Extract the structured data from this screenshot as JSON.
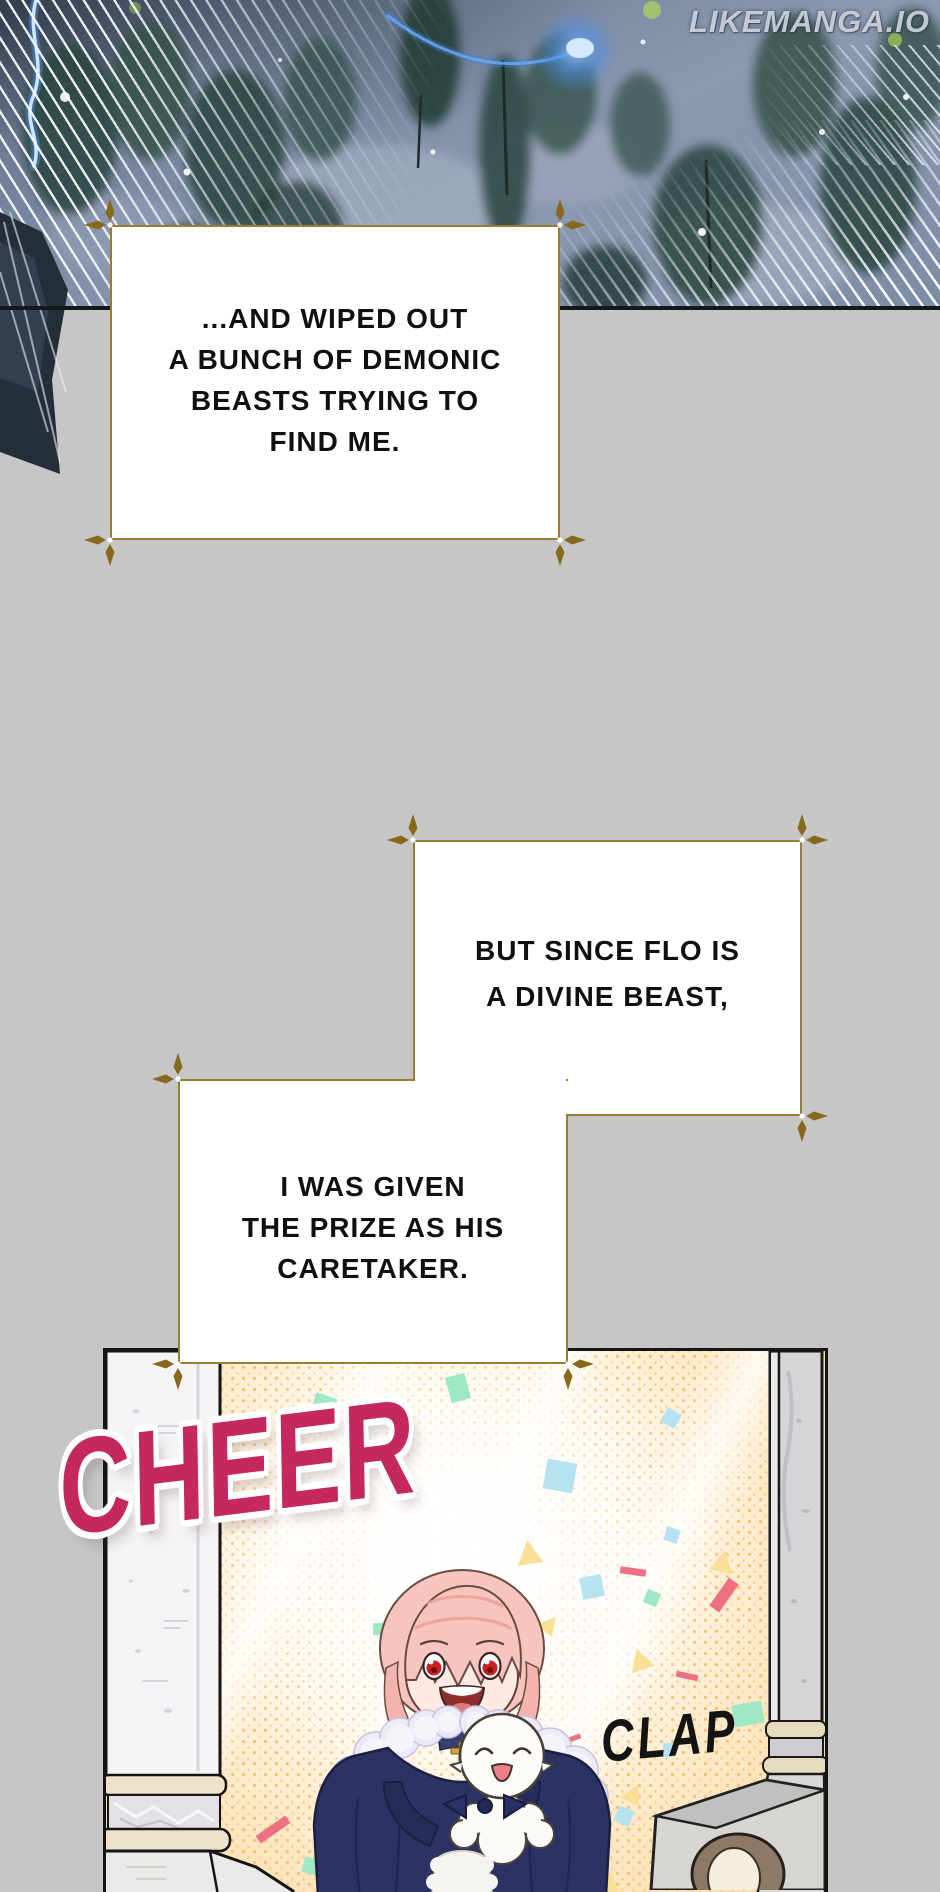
{
  "watermark": {
    "text": "LIKEMANGA.IO"
  },
  "narration": {
    "box1": {
      "lines": [
        "...AND WIPED OUT",
        "A BUNCH OF DEMONIC",
        "BEASTS TRYING TO",
        "FIND ME."
      ]
    },
    "box2": {
      "lines": [
        "BUT SINCE FLO IS",
        "A DIVINE BEAST,"
      ]
    },
    "box3": {
      "lines": [
        "I WAS GIVEN",
        "THE PRIZE AS HIS",
        "CARETAKER."
      ]
    }
  },
  "sfx": {
    "cheer": "CHEER",
    "clap": "CLAP"
  },
  "colors": {
    "background_gray": "#c6c6c6",
    "box_border_gold": "#9a7c33",
    "corner_marker_gold": "#86691d",
    "cheer_pink": "#c5285c",
    "panel_cream": "#fffaf0",
    "halftone_orange": "#f2bf6e",
    "cloak_navy": "#2c3263",
    "hair_pink": "#f6c5bf",
    "eye_red": "#c92121",
    "forest_slate": "#8493ab",
    "lightning_blue": "#4d8fe8"
  }
}
